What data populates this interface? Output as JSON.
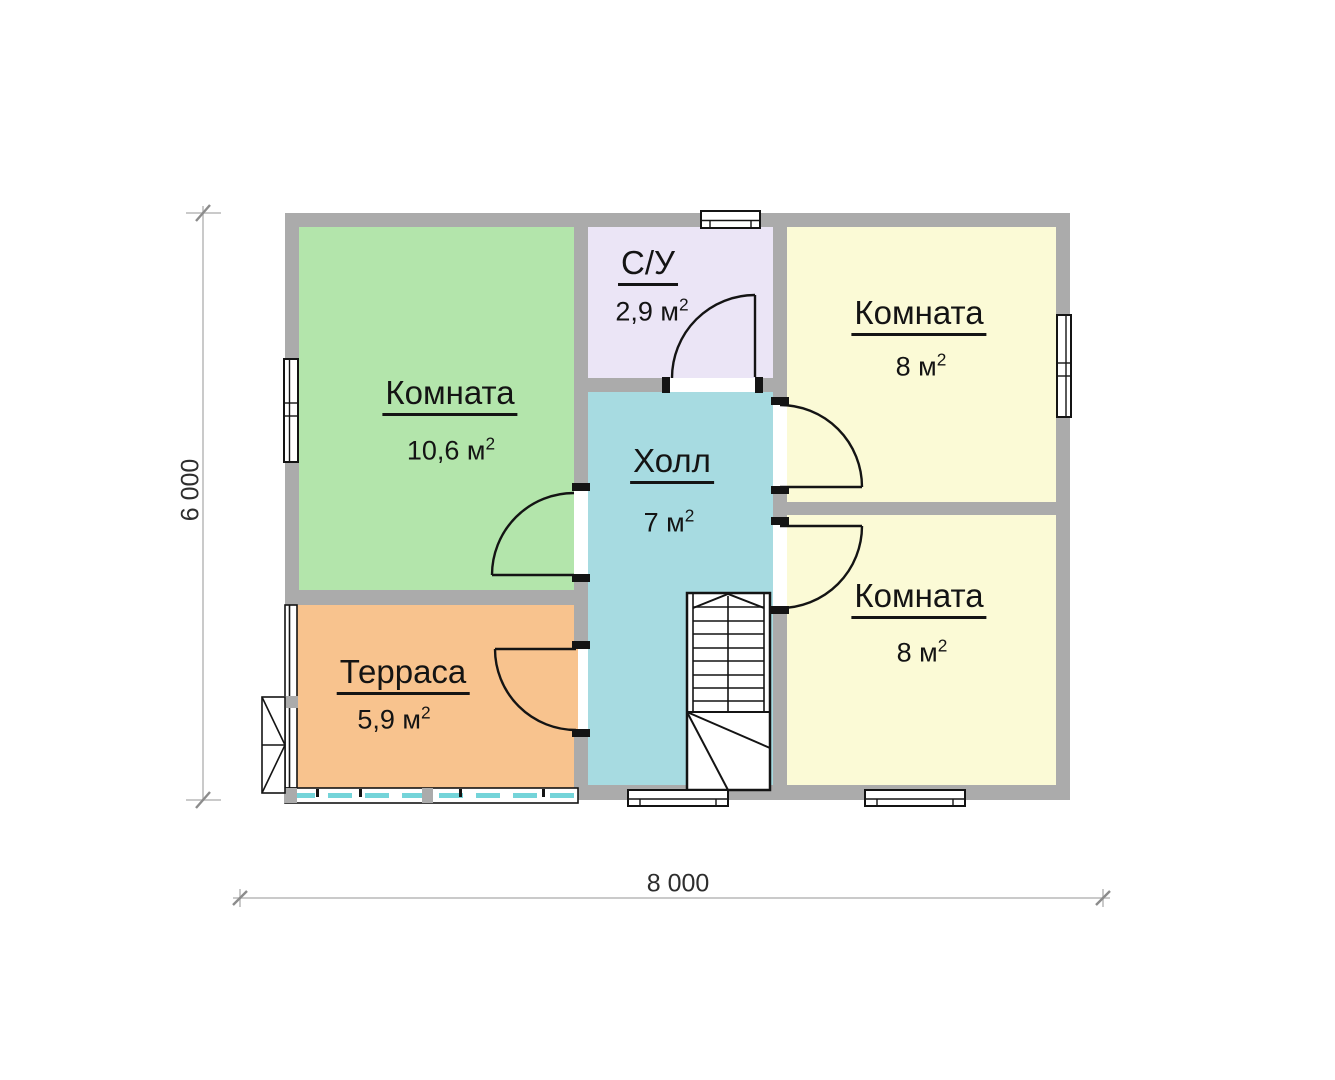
{
  "plan": {
    "rooms": [
      {
        "name": "Комната",
        "area": "10,6 м",
        "sup": "2",
        "color": "#b3e5ab"
      },
      {
        "name": "С/У",
        "area": "2,9 м",
        "sup": "2",
        "color": "#ebe5f6"
      },
      {
        "name": "Комната",
        "area": "8 м",
        "sup": "2",
        "color": "#fbfad6"
      },
      {
        "name": "Холл",
        "area": "7 м",
        "sup": "2",
        "color": "#a7dbe1"
      },
      {
        "name": "Комната",
        "area": "8 м",
        "sup": "2",
        "color": "#fbfad6"
      },
      {
        "name": "Терраса",
        "area": "5,9 м",
        "sup": "2",
        "color": "#f8c38e"
      }
    ],
    "dimensions": {
      "width": "8 000",
      "height": "6 000"
    },
    "colors": {
      "wall": "#ababab",
      "line": "#141414",
      "glazing": "#74d4d9",
      "dim_line": "#b9b9b9",
      "dim_tick": "#8c8c8c",
      "dim_text": "#2e2e2e"
    }
  }
}
